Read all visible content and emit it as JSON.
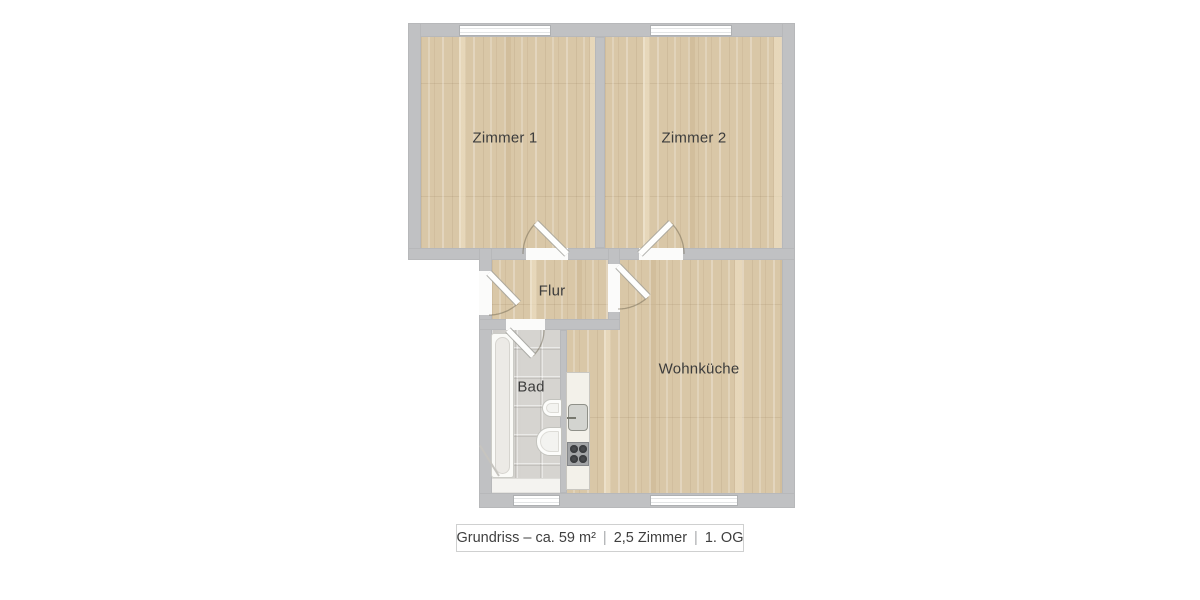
{
  "plan": {
    "rooms": {
      "zimmer1": {
        "label": "Zimmer 1"
      },
      "zimmer2": {
        "label": "Zimmer 2"
      },
      "flur": {
        "label": "Flur"
      },
      "bad": {
        "label": "Bad"
      },
      "wohnkueche": {
        "label": "Wohnküche"
      }
    },
    "fixtures": {
      "bathtub": "bathtub",
      "washbasin": "washbasin",
      "toilet": "toilet",
      "kitchen_counter": "kitchen-counter",
      "kitchen_sink": "kitchen-sink",
      "stove": "stove-4-burners"
    },
    "colors": {
      "wall": "#c0c1c3",
      "wood_floor": "#d9c7a7",
      "tile_floor": "#d6d4d0",
      "window": "#ffffff",
      "background": "#ffffff"
    }
  },
  "caption": {
    "full": "Grundriss – ca. 59 m² | 2,5 Zimmer | 1. OG",
    "part_plan": "Grundriss – ca. 59 m²",
    "part_rooms": "2,5 Zimmer",
    "part_floor": "1. OG",
    "separator": "|"
  }
}
